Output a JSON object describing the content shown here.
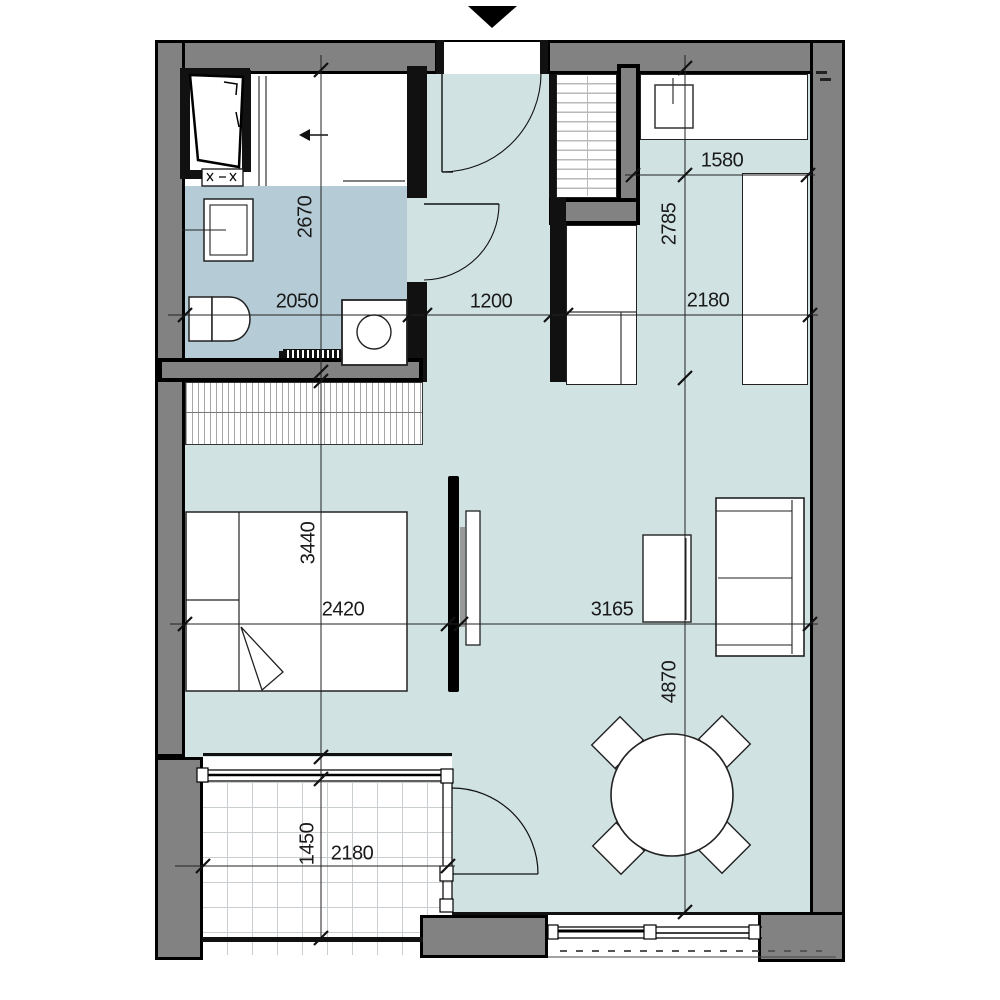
{
  "floorplan": {
    "kind": "apartment-floor-plan",
    "entrance_side": "top",
    "dims": {
      "bath_depth": "2670",
      "bath_width": "2050",
      "hall_width": "1200",
      "kitchen_width": "2180",
      "kitchen_run": "1580",
      "kitchen_depth": "2785",
      "bedroom_depth": "3440",
      "bedroom_width": "2420",
      "living_width": "3165",
      "living_depth": "4870",
      "balcony_depth": "1450",
      "balcony_width": "2180"
    },
    "colors": {
      "exterior_wall": "#828282",
      "interior_wall": "#111111",
      "bathroom_floor": "#b5ccd7",
      "main_floor": "#d0e2e2",
      "outline": "#000000"
    },
    "rooms": [
      "bathroom",
      "hall",
      "kitchen",
      "bedroom",
      "living-room",
      "balcony"
    ],
    "fixtures": [
      "bed",
      "wardrobe",
      "hall-closet",
      "sofa",
      "coffee-table",
      "dining-table",
      "dining-chairs",
      "toilet",
      "wash-basin",
      "washing-machine",
      "towel-radiator",
      "kitchen-counter",
      "kitchen-sink",
      "tv-panel",
      "room-divider",
      "shaft"
    ]
  }
}
